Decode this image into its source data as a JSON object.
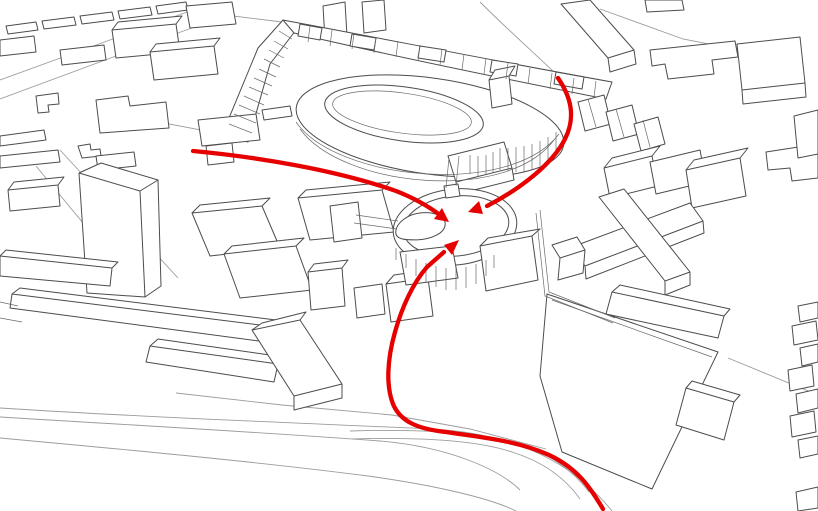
{
  "canvas": {
    "width": 818,
    "height": 511,
    "background": "#ffffff"
  },
  "palette": {
    "building_line": "#4c4c4c",
    "detail_line": "#6a6a6a",
    "road_line": "#9c9c9c",
    "route_accent": "#e60000",
    "ground": "#ffffff"
  },
  "layers": [
    {
      "name": "streets",
      "stroke": "#9c9c9c",
      "strokeWidth": 0.9,
      "fill": "none",
      "paths": [
        {
          "name": "street-topleft-a",
          "d": "M0,80 L198,8"
        },
        {
          "name": "street-topleft-b",
          "d": "M0,99 L232,13"
        },
        {
          "name": "street-terrace-link",
          "d": "M185,10 L282,22"
        },
        {
          "name": "street-left-diag-a",
          "d": "M60,150 L178,278"
        },
        {
          "name": "street-left-diag-b",
          "d": "M36,166 L140,292"
        },
        {
          "name": "street-tower-link",
          "d": "M148,120 L222,134"
        },
        {
          "name": "street-top-center",
          "d": "M480,2 C512,34 538,56 559,77"
        },
        {
          "name": "street-topright",
          "d": "M600,9 L683,39 L744,51"
        },
        {
          "name": "road-bottom-upper",
          "d": "M0,408 C140,417 300,423 432,429 C520,434 575,465 612,511"
        },
        {
          "name": "road-bottom-mid",
          "d": "M0,417 C130,425 260,432 380,441 C450,447 500,470 520,490"
        },
        {
          "name": "road-bottom-lower",
          "d": "M0,438 C130,450 260,462 368,476 C440,486 492,499 516,511"
        },
        {
          "name": "path-by-route-a",
          "d": "M350,431 C420,429 480,432 519,444 C552,454 575,473 589,492"
        },
        {
          "name": "path-by-route-b",
          "d": "M352,439 C420,437 476,440 512,452 C544,462 566,479 580,499"
        },
        {
          "name": "ground-edge-center",
          "d": "M176,393 L282,405 L392,415 L470,429 L546,449"
        },
        {
          "name": "road-right-of-platform",
          "d": "M728,358 L818,395"
        }
      ]
    },
    {
      "name": "buildings",
      "stroke": "#4c4c4c",
      "strokeWidth": 1,
      "fill": "#ffffff",
      "linejoin": "round",
      "paths": [
        {
          "name": "strip-row1-a",
          "d": "M6,26 L36,22 L38,30 L8,34 Z"
        },
        {
          "name": "strip-row1-b",
          "d": "M42,21 L74,17 L76,25 L44,29 Z"
        },
        {
          "name": "strip-row1-c",
          "d": "M80,16 L112,12 L114,20 L82,24 Z"
        },
        {
          "name": "strip-row1-d",
          "d": "M118,11 L150,7 L152,15 L120,19 Z"
        },
        {
          "name": "strip-row1-e",
          "d": "M156,6 L186,2 L188,10 L158,14 Z"
        },
        {
          "name": "block-topleft-a",
          "d": "M112,30 L176,24 L180,52 L116,58 Z M112,30 L118,22 L182,16 L176,24 Z"
        },
        {
          "name": "block-topleft-b",
          "d": "M150,52 L214,46 L218,74 L154,80 Z M150,52 L156,44 L220,38 L214,46 Z"
        },
        {
          "name": "block-top-edge",
          "d": "M186,6 L232,2 L236,24 L190,28 Z"
        },
        {
          "name": "strip-row2",
          "d": "M60,50 L104,45 L106,60 L62,65 Z"
        },
        {
          "name": "block-left-edge",
          "d": "M0,40 L34,36 L36,52 L0,56 Z"
        },
        {
          "name": "building-l-shape",
          "d": "M96,100 L128,96 L130,106 L166,102 L169,128 L100,133 Z"
        },
        {
          "name": "building-small-l",
          "d": "M36,96 L58,93 L59,104 L48,105 L49,112 L38,113 Z"
        },
        {
          "name": "strip-left-a",
          "d": "M0,136 L44,130 L46,140 L0,146 Z"
        },
        {
          "name": "strip-left-b",
          "d": "M0,156 L58,150 L60,162 L0,168 Z"
        },
        {
          "name": "building-cross-tiny",
          "d": "M78,146 L90,144 L91,150 L100,149 L101,156 L82,158 Z"
        },
        {
          "name": "strip-left-c",
          "d": "M96,156 L134,152 L136,166 L98,170 Z"
        },
        {
          "name": "cube-top-center-a",
          "d": "M323,6 L345,2 L347,36 L325,40 Z"
        },
        {
          "name": "cube-top-center-b",
          "d": "M362,2 L384,0 L386,30 L364,33 Z"
        },
        {
          "name": "terrace-band-steep",
          "d": "M222,135 L258,48 L283,20 L296,30 L270,64 L248,142 Z"
        },
        {
          "name": "terrace-band-arc",
          "d": "M283,20 C390,40 500,62 612,82 L606,99 C500,78 392,56 294,33 Z"
        },
        {
          "name": "terrace-base-block-a",
          "d": "M198,120 L256,114 L260,140 L202,146 Z"
        },
        {
          "name": "terrace-base-block-b",
          "d": "M206,146 L232,143 L234,162 L208,165 Z"
        },
        {
          "name": "band-box-a",
          "d": "M300,24 L322,28 L320,40 L298,36 Z"
        },
        {
          "name": "band-box-b",
          "d": "M352,34 L376,38 L374,50 L350,46 Z"
        },
        {
          "name": "band-box-c",
          "d": "M420,46 L446,50 L444,62 L418,58 Z"
        },
        {
          "name": "band-box-d",
          "d": "M492,60 L518,64 L516,76 L490,72 Z"
        },
        {
          "name": "band-box-e",
          "d": "M556,72 L584,77 L582,89 L554,84 Z"
        },
        {
          "name": "strip-left-of-loop",
          "d": "M262,110 L290,106 L292,116 L264,120 Z"
        },
        {
          "name": "loop-building-roof",
          "d": "M-135,0 a135,48 0 1 0 270,0 a135,48 0 1 0 -270,0 Z",
          "transform": "translate(430,126) rotate(8)"
        },
        {
          "name": "loop-building-hole",
          "d": "M-80,0 a80,27 0 1 0 160,0 a80,27 0 1 0 -160,0 Z",
          "transform": "translate(404,114) rotate(8)"
        },
        {
          "name": "loop-roof-tower",
          "d": "M489,80 L509,76 L512,104 L492,108 Z M489,80 L495,70 L515,66 L509,76 Z"
        },
        {
          "name": "loop-annex-steps",
          "d": "M448,156 L504,142 L512,168 L456,182 Z M456,182 L512,168 L514,180 L458,194 Z"
        },
        {
          "name": "slab-topright-diag",
          "d": "M561,4 L590,0 L634,50 L608,58 Z M608,58 L634,50 L636,64 L610,72 Z"
        },
        {
          "name": "stub-top-edge",
          "d": "M645,0 L682,0 L684,10 L647,12 Z"
        },
        {
          "name": "building-topright-lflat",
          "d": "M650,50 L735,41 L738,57 L712,60 L714,74 L668,79 L665,64 L652,66 Z"
        },
        {
          "name": "slab-topright-big",
          "d": "M737,44 L800,37 L805,83 L742,90 Z M742,90 L805,83 L806,97 L743,104 Z"
        },
        {
          "name": "plate-right-notched",
          "d": "M766,152 L818,144 L818,178 L792,181 L790,168 L768,170 Z"
        },
        {
          "name": "box-right-edge-mid",
          "d": "M794,116 L818,110 L818,154 L798,158 Z"
        },
        {
          "name": "gabled-house-a",
          "d": "M578,102 L604,95 L611,124 L585,131 Z"
        },
        {
          "name": "gabled-house-b",
          "d": "M606,112 L632,105 L639,134 L613,141 Z"
        },
        {
          "name": "gabled-house-c",
          "d": "M634,124 L658,117 L665,144 L641,151 Z"
        },
        {
          "name": "cluster-box-top-a",
          "d": "M604,168 L652,156 L658,186 L610,198 Z M604,168 L612,158 L660,146 L652,156 Z"
        },
        {
          "name": "cluster-box-top-b",
          "d": "M650,162 L700,150 L706,182 L656,194 Z"
        },
        {
          "name": "cluster-box-top-c",
          "d": "M686,170 L740,158 L746,196 L692,208 Z M686,170 L694,160 L748,148 L740,158 Z"
        },
        {
          "name": "cluster-x-bar-ne",
          "d": "M572,247 L690,203 L703,221 L585,266 Z M585,266 L703,221 L704,233 L586,279 Z"
        },
        {
          "name": "cluster-x-bar-nw",
          "d": "M599,197 L624,189 L690,272 L665,281 Z M665,281 L690,272 L690,285 L665,295 Z"
        },
        {
          "name": "cluster-cube",
          "d": "M552,245 L577,237 L585,250 L560,258 Z M560,258 L585,250 L583,273 L558,280 Z"
        },
        {
          "name": "platform-large",
          "d": "M547,294 L718,352 L652,489 L562,452 L540,376 Z"
        },
        {
          "name": "slab-on-platform",
          "d": "M612,292 L724,316 L718,338 L606,314 Z M612,292 L620,285 L730,309 L724,316 Z"
        },
        {
          "name": "platform-side-box",
          "d": "M686,388 L734,402 L724,440 L676,425 Z M686,388 L692,381 L740,395 L734,402 Z"
        },
        {
          "name": "tower-tall",
          "d": "M79,173 L101,163 L158,180 L140,191 Z M79,173 L140,191 L145,297 L87,293 Z M140,191 L158,180 L161,286 L145,297 Z"
        },
        {
          "name": "block-left-of-tower",
          "d": "M8,190 L58,185 L60,206 L10,211 Z M8,190 L14,182 L64,177 L58,185 Z"
        },
        {
          "name": "bar-low-left",
          "d": "M0,256 L112,268 L110,286 L0,276 Z M0,256 L6,250 L118,262 L112,268 Z"
        },
        {
          "name": "bar-long-left",
          "d": "M12,294 L268,326 L266,342 L10,308 Z M12,294 L20,288 L276,320 L268,326 Z"
        },
        {
          "name": "bar-long-left-b",
          "d": "M150,346 L278,364 L274,382 L146,362 Z M150,346 L158,339 L284,357 L278,364 Z"
        },
        {
          "name": "slab-mid-a",
          "d": "M192,213 L262,206 L280,248 L210,256 Z M192,213 L200,205 L270,198 L262,206 Z"
        },
        {
          "name": "slab-mid-b",
          "d": "M224,254 L296,246 L312,290 L240,298 Z M224,254 L232,246 L304,238 L296,246 Z"
        },
        {
          "name": "slab-mid-c",
          "d": "M298,198 L382,190 L394,232 L310,240 Z M298,198 L306,190 L390,182 L382,190 Z"
        },
        {
          "name": "tower-small-mid",
          "d": "M308,272 L342,268 L345,306 L311,310 Z M308,272 L314,264 L348,260 L342,268 Z"
        },
        {
          "name": "house-mid",
          "d": "M354,288 L382,284 L385,314 L357,318 Z"
        },
        {
          "name": "gabled-box-mid",
          "d": "M386,284 L428,278 L433,316 L391,322 Z M386,284 L394,275 L436,269 L428,278 Z"
        },
        {
          "name": "bar-angled-bottom",
          "d": "M252,330 L300,320 L342,384 L294,396 Z M252,330 L262,323 L306,312 L300,320 Z M294,396 L342,384 L342,398 L294,410 Z"
        },
        {
          "name": "walkway-platform-west",
          "d": "M330,206 L358,202 L362,238 L334,242 Z"
        },
        {
          "name": "pavilion-ring-outer",
          "d": "M-62,0 a62,38 0 1 0 124,0 a62,38 0 1 0 -124,0 Z",
          "transform": "translate(455,227) rotate(-6)"
        },
        {
          "name": "pavilion-ring-inner",
          "d": "M-53,0 a53,30 0 1 0 106,0 a53,30 0 1 0 -106,0 Z",
          "transform": "translate(456,226) rotate(-6)"
        },
        {
          "name": "pavilion-entry-connector",
          "d": "M444,186 L458,184 L460,196 L446,198 Z"
        },
        {
          "name": "pavilion-blob",
          "d": "M-26,2 C-24,-8 -10,-14 2,-13 C16,-12 26,-5 24,3 C22,11 8,15 -6,13 C-18,11 -27,9 -26,2 Z",
          "transform": "translate(421,226) rotate(-10)"
        },
        {
          "name": "pavilion-annex-left",
          "d": "M400,252 L452,246 L458,278 L406,285 Z"
        },
        {
          "name": "pavilion-annex-right",
          "d": "M480,246 L532,236 L538,280 L486,291 Z M480,246 L488,238 L540,229 L532,236 Z"
        },
        {
          "name": "right-edge-box-a",
          "d": "M798,306 L818,302 L818,318 L800,322 Z"
        },
        {
          "name": "right-edge-box-b",
          "d": "M792,326 L816,321 L818,340 L794,345 Z"
        },
        {
          "name": "right-edge-box-c",
          "d": "M800,348 L818,344 L818,362 L802,366 Z"
        },
        {
          "name": "right-edge-box-d",
          "d": "M788,370 L812,365 L814,386 L790,391 Z"
        },
        {
          "name": "right-edge-box-e",
          "d": "M796,394 L818,389 L818,408 L798,413 Z"
        },
        {
          "name": "right-edge-box-f",
          "d": "M790,416 L814,411 L816,432 L792,437 Z"
        },
        {
          "name": "right-edge-box-g",
          "d": "M798,440 L818,436 L818,454 L800,458 Z"
        },
        {
          "name": "right-corner-box",
          "d": "M796,492 L818,487 L818,508 L798,511 Z"
        }
      ]
    },
    {
      "name": "details",
      "stroke": "#6a6a6a",
      "strokeWidth": 0.7,
      "fill": "none",
      "paths": [
        {
          "name": "terrace-hatching",
          "d": "M229,124 L252,133 M234,114 L256,123 M239,105 L260,114 M244,96 L264,105 M249,87 L268,95 M254,78 L272,86 M259,69 L276,77 M264,59 L280,67 M269,50 L284,58 M274,41 L288,49 M279,31 L292,39"
        },
        {
          "name": "band-module-ticks",
          "d": "M310,26 L308,42 M332,30 L330,46 M354,33 L352,49 M376,37 L374,53 M398,41 L396,57 M420,45 L418,61 M442,49 L440,65 M464,54 L462,70 M486,58 L484,74 M508,63 L506,79 M530,68 L528,84 M552,73 L550,89 M574,78 L572,94 M596,81 L594,97"
        },
        {
          "name": "loop-roof-thickness-a",
          "d": "M296,122 C336,180 510,198 559,134"
        },
        {
          "name": "loop-roof-thickness-b",
          "d": "M300,129 C342,187 506,204 554,140"
        },
        {
          "name": "loop-inner-ring-line",
          "d": "M-70,0 a70,20 0 1 0 140,0 a70,20 0 1 0 -140,0",
          "transform": "translate(402,113) rotate(8)"
        },
        {
          "name": "loop-columns",
          "d": "M470,155 L470,174 M478,156 L478,176 M486,155 L486,175 M493,152 L493,173 M500,148 L500,170 M508,148 L508,171 M516,147 L516,172 M524,146 L524,172 M532,144 L532,170 M540,141 L540,166 M548,137 L548,160 M556,132 L556,152"
        },
        {
          "name": "pavilion-columns",
          "d": "M396,248 L396,260 M406,254 L406,268 M416,259 L416,276 M426,263 L426,282 M436,266 L436,287 M446,268 L446,290 M456,268 L456,290 M466,267 L466,288 M476,264 L476,284 M486,260 L486,276 M494,255 L494,268"
        },
        {
          "name": "pavilion-walkway-lines",
          "d": "M356,215 L398,221 M354,223 L397,229"
        },
        {
          "name": "pavilion-link-to-loop",
          "d": "M449,158 L446,188 M459,156 L456,186"
        },
        {
          "name": "house-ridges",
          "d": "M588,99 L596,127 M616,109 L624,137 M643,120 L650,147"
        },
        {
          "name": "cluster-retaining-wall",
          "d": "M536,213 L545,296 L613,323 M540,210 L549,292 L615,318"
        },
        {
          "name": "platform-top-edge-line",
          "d": "M552,300 L712,357"
        },
        {
          "name": "left-edge-marks",
          "d": "M0,302 L18,306 M0,318 L22,322"
        }
      ]
    },
    {
      "name": "routes",
      "stroke": "#e60000",
      "strokeWidth": 4.3,
      "fill": "none",
      "linecap": "round",
      "paths": [
        {
          "name": "route-west",
          "d": "M193,151 C258,157 336,170 396,191 C414,198 428,206 440,215"
        },
        {
          "name": "route-north",
          "d": "M558,78 C571,97 576,117 565,139 C553,163 522,188 487,206"
        },
        {
          "name": "route-south",
          "d": "M603,509 C590,487 577,468 549,455 C516,440 478,437 446,432 C417,429 400,421 393,404 C386,386 387,360 395,332 C402,307 413,283 427,267 L444,252"
        }
      ]
    },
    {
      "name": "arrowheads",
      "stroke": "none",
      "fill": "#e60000",
      "paths": [
        {
          "name": "arrowhead-west",
          "d": "M449,222 L434,219 L442,208 Z"
        },
        {
          "name": "arrowhead-north",
          "d": "M468,212 L479,201 L483,214 Z"
        },
        {
          "name": "arrowhead-south",
          "d": "M459,240 L452,255 L444,245 Z"
        }
      ]
    }
  ]
}
